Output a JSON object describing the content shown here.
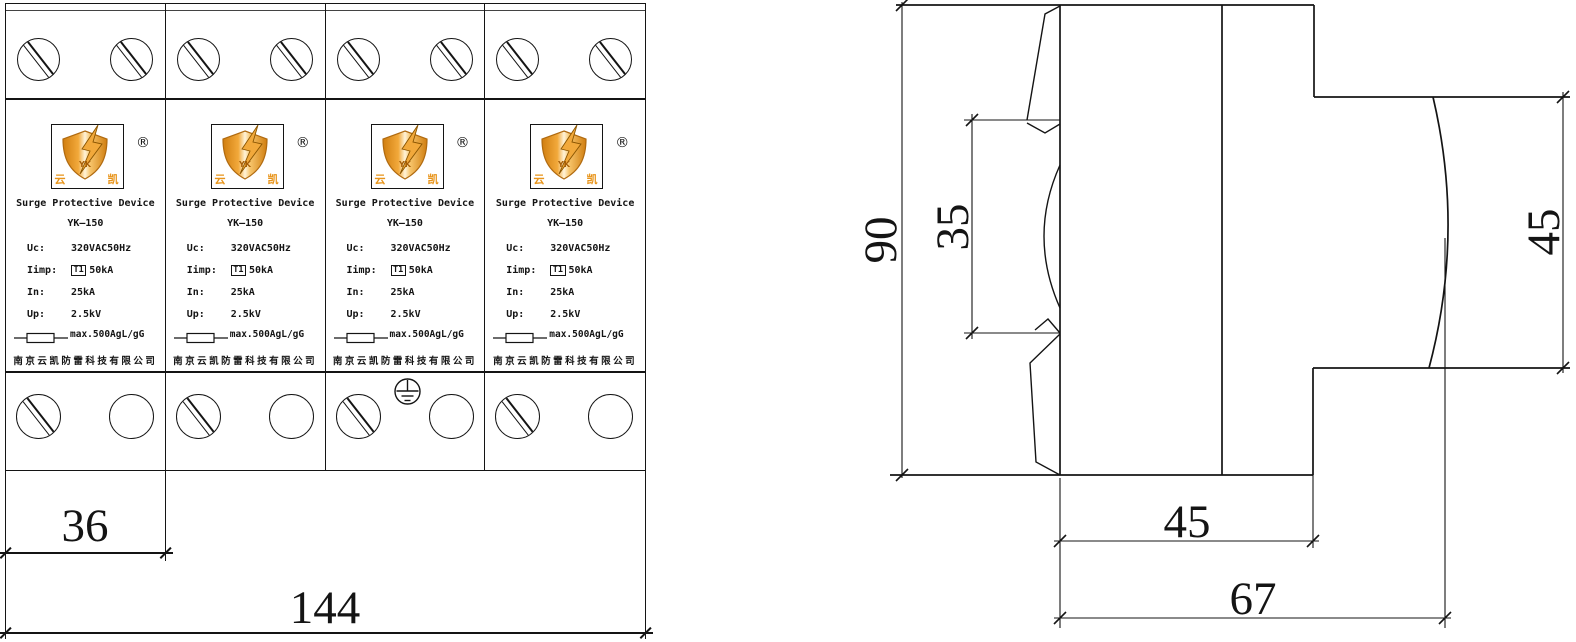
{
  "drawing": {
    "colors": {
      "line": "#141414",
      "logo_orange": "#E8941A",
      "logo_deep_orange": "#C9780E",
      "logo_light": "#FFF3D8"
    },
    "front_view": {
      "module_count": 4,
      "module": {
        "reg_mark": "®",
        "product_name": "Surge Protective Device",
        "model": "YK—150",
        "specs": [
          {
            "label": "Uc:",
            "value": "320VAC50Hz"
          },
          {
            "label": "Iimp:",
            "badge": "T1",
            "value": "50kA"
          },
          {
            "label": "In:",
            "value": "25kA"
          },
          {
            "label": "Up:",
            "value": "2.5kV"
          }
        ],
        "fuse_rating": "max.500AgL/gG",
        "company": "南京云凯防雷科技有限公司",
        "logo": {
          "left_char": "云",
          "right_char": "凯",
          "center_text": "YK"
        }
      },
      "dims": {
        "module_width": "36",
        "total_width": "144"
      }
    },
    "side_view": {
      "dims": {
        "overall_height": "90",
        "rail_slot_height": "35",
        "front_block_height": "45",
        "base_width": "45",
        "overall_depth": "67"
      }
    }
  }
}
